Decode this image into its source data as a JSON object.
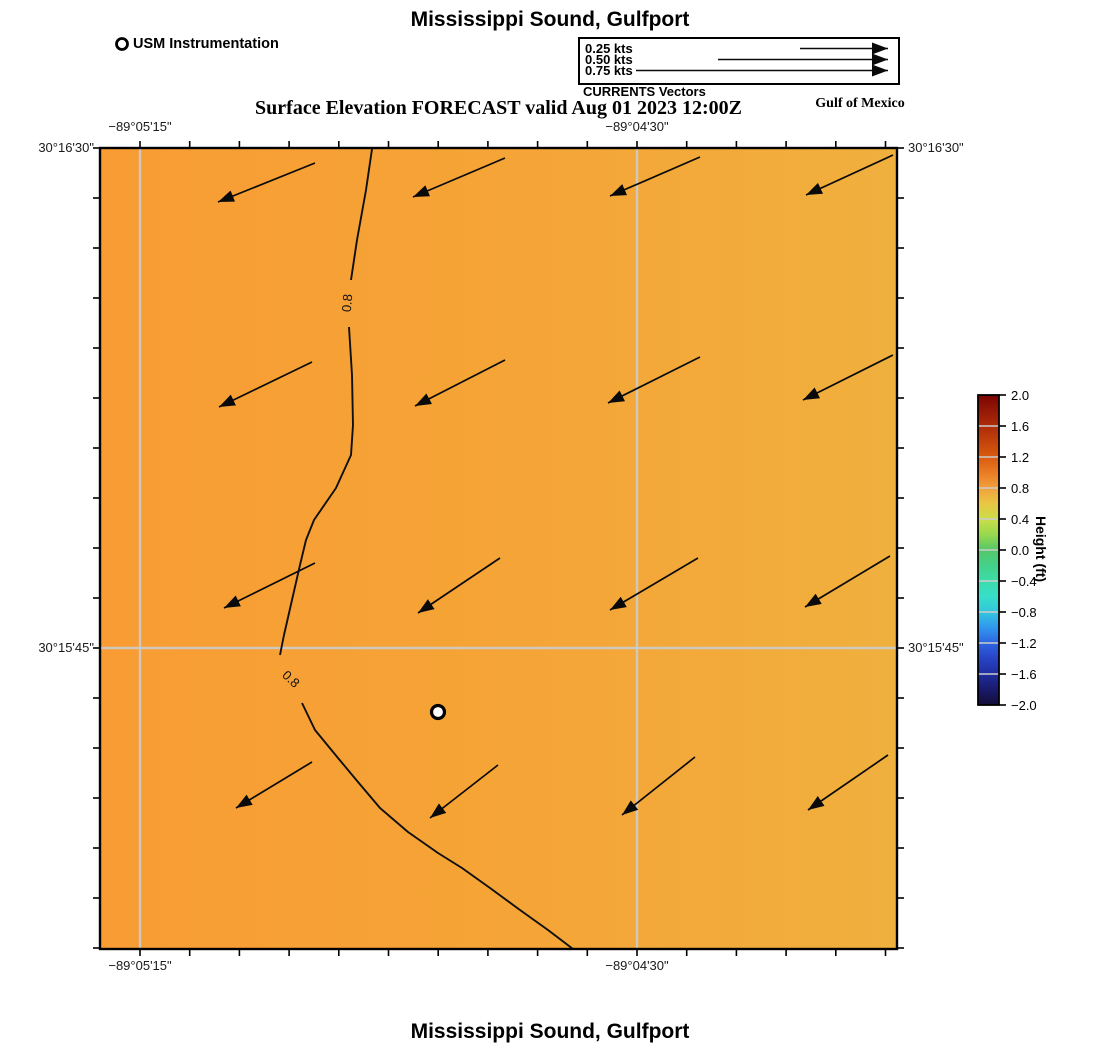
{
  "header": {
    "title": "Mississippi Sound, Gulfport",
    "station_legend_label": "USM Instrumentation",
    "currents_legend": {
      "caption": "CURRENTS Vectors",
      "items": [
        {
          "label": "0.25 kts",
          "tail_x": 800,
          "y": 48.5
        },
        {
          "label": "0.50 kts",
          "tail_x": 718,
          "y": 59.5
        },
        {
          "label": "0.75 kts",
          "tail_x": 636,
          "y": 70.5
        }
      ],
      "arrow_tip_x": 888
    },
    "subtitle": "Surface Elevation FORECAST valid Aug 01 2023 12:00Z",
    "region_label": "Gulf of Mexico"
  },
  "footer": {
    "title": "Mississippi Sound, Gulfport"
  },
  "axes": {
    "lon_ticks": [
      {
        "label": "−89°05'15\"",
        "x": 140
      },
      {
        "label": "−89°04'30\"",
        "x": 637
      }
    ],
    "lat_ticks": [
      {
        "label": "30°16'30\"",
        "y": 148
      },
      {
        "label": "30°15'45\"",
        "y": 648
      }
    ]
  },
  "colors": {
    "map_left": "#f89c33",
    "map_mid": "#f5a537",
    "map_right": "#f0b03e",
    "grid": "#cccccc",
    "frame": "#000000",
    "arrow": "#0a0a0a"
  },
  "map": {
    "contour": {
      "level_label": "0.8",
      "segments": [
        [
          [
            272,
            1
          ],
          [
            266,
            42
          ],
          [
            257,
            92
          ],
          [
            251,
            132
          ]
        ],
        [
          [
            249,
            179
          ],
          [
            252,
            227
          ],
          [
            253,
            277
          ],
          [
            251,
            307
          ],
          [
            236,
            340
          ],
          [
            214,
            372
          ],
          [
            206,
            392
          ],
          [
            200,
            417
          ],
          [
            192,
            452
          ],
          [
            184,
            487
          ],
          [
            180,
            507
          ]
        ],
        [
          [
            202,
            555
          ],
          [
            215,
            582
          ],
          [
            238,
            610
          ],
          [
            258,
            634
          ],
          [
            280,
            660
          ],
          [
            308,
            684
          ],
          [
            338,
            705
          ],
          [
            362,
            720
          ],
          [
            390,
            740
          ],
          [
            420,
            762
          ],
          [
            448,
            782
          ],
          [
            473,
            801
          ]
        ]
      ],
      "labels": [
        {
          "x": 347,
          "y": 303,
          "rot": -85
        },
        {
          "x": 291,
          "y": 679,
          "rot": 43
        }
      ]
    },
    "station_marker_px": {
      "x": 338,
      "y": 564
    },
    "current_vectors_px": [
      [
        215,
        15,
        118,
        54
      ],
      [
        405,
        10,
        313,
        49
      ],
      [
        600,
        9,
        510,
        48
      ],
      [
        793,
        7,
        706,
        47
      ],
      [
        212,
        214,
        119,
        259
      ],
      [
        405,
        212,
        315,
        258
      ],
      [
        600,
        209,
        508,
        255
      ],
      [
        793,
        207,
        703,
        252
      ],
      [
        215,
        415,
        124,
        460
      ],
      [
        400,
        410,
        318,
        465
      ],
      [
        598,
        410,
        510,
        462
      ],
      [
        790,
        408,
        705,
        459
      ],
      [
        212,
        614,
        136,
        660
      ],
      [
        398,
        617,
        330,
        670
      ],
      [
        595,
        609,
        522,
        667
      ],
      [
        788,
        607,
        708,
        662
      ]
    ]
  },
  "colorbar": {
    "label": "Height (ft)",
    "tick_labels": [
      "2.0",
      "1.6",
      "1.2",
      "0.8",
      "0.4",
      "0.0",
      "−0.4",
      "−0.8",
      "−1.2",
      "−1.6",
      "−2.0"
    ],
    "stops": [
      {
        "v": 2.0,
        "c": "#7a0403"
      },
      {
        "v": 1.8,
        "c": "#941806"
      },
      {
        "v": 1.6,
        "c": "#ad2c0a"
      },
      {
        "v": 1.4,
        "c": "#c4420b"
      },
      {
        "v": 1.2,
        "c": "#d95b10"
      },
      {
        "v": 1.0,
        "c": "#e97b24"
      },
      {
        "v": 0.8,
        "c": "#f2a13c"
      },
      {
        "v": 0.6,
        "c": "#e9c643"
      },
      {
        "v": 0.4,
        "c": "#cbdd49"
      },
      {
        "v": 0.2,
        "c": "#97d94e"
      },
      {
        "v": 0.0,
        "c": "#55c768"
      },
      {
        "v": -0.2,
        "c": "#44d189"
      },
      {
        "v": -0.4,
        "c": "#3cdcab"
      },
      {
        "v": -0.6,
        "c": "#37dfc9"
      },
      {
        "v": -0.8,
        "c": "#33c5dc"
      },
      {
        "v": -1.0,
        "c": "#3097ee"
      },
      {
        "v": -1.2,
        "c": "#2e64e2"
      },
      {
        "v": -1.4,
        "c": "#2744c4"
      },
      {
        "v": -1.6,
        "c": "#1f2d9f"
      },
      {
        "v": -1.8,
        "c": "#191a6b"
      },
      {
        "v": -2.0,
        "c": "#130d38"
      }
    ]
  },
  "chart_data": {
    "type": "heatmap",
    "subtype": "coastal surface-elevation forecast map with current vector field and contour",
    "title": "Mississippi Sound, Gulfport",
    "annotation": "Surface Elevation FORECAST valid Aug 01 2023 12:00Z",
    "region_label": "Gulf of Mexico",
    "x_axis": {
      "label": "longitude",
      "ticks": [
        "−89°05'15\"",
        "−89°04'30\""
      ]
    },
    "y_axis": {
      "label": "latitude",
      "ticks": [
        "30°16'30\"",
        "30°15'45\""
      ]
    },
    "colorbar": {
      "label": "Height (ft)",
      "min": -2.0,
      "max": 2.0,
      "tick_step": 0.4
    },
    "field_summary": "surface elevation approx 0.7–0.9 ft across domain; 0.8 ft contour runs roughly N–S through the west-central area then bends southeast to exit the bottom edge",
    "contour_levels_ft": [
      0.8
    ],
    "vectors": {
      "legend_speeds_kts": [
        0.25,
        0.5,
        0.75
      ],
      "grid": "4x4",
      "direction": "toward southwest",
      "approx_speed_kts": 0.3
    },
    "station": {
      "name": "USM Instrumentation",
      "marker": "white circle with black outline"
    }
  }
}
